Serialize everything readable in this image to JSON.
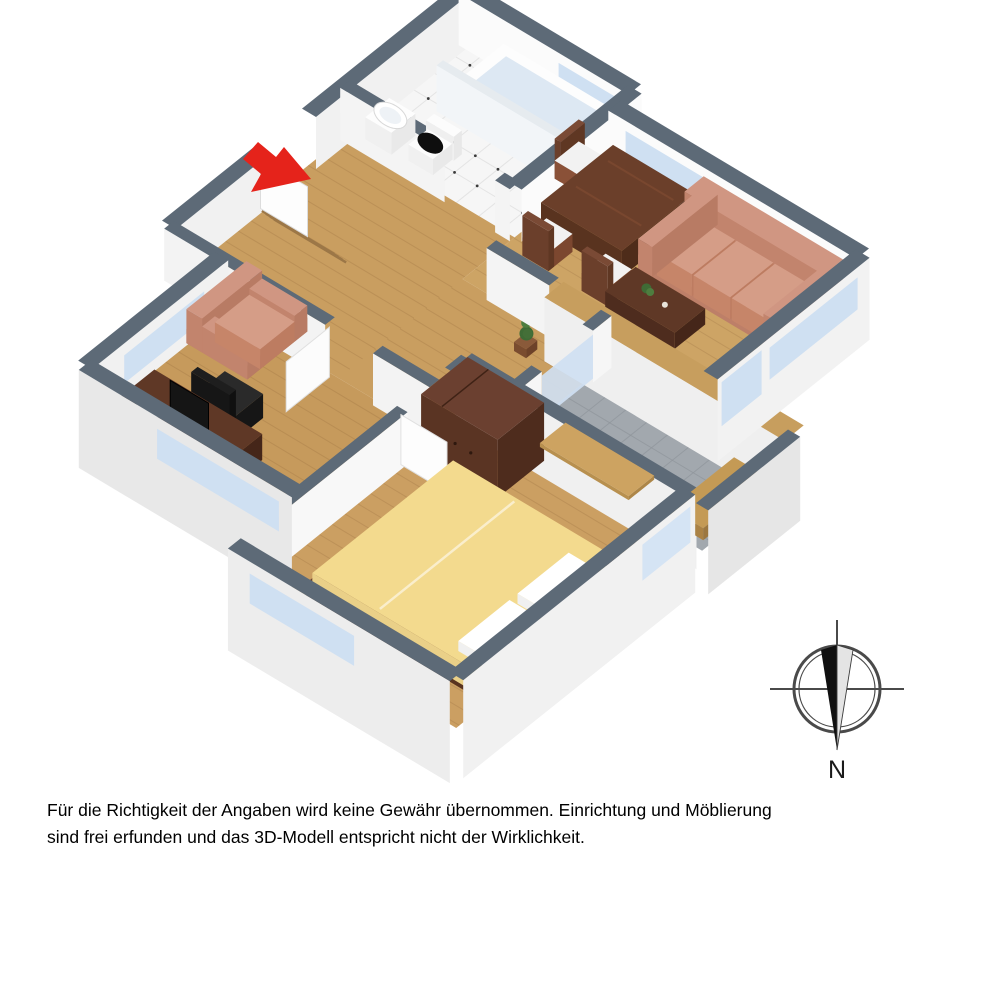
{
  "disclaimer": {
    "line1": "Für die Richtigkeit der Angaben wird keine Gewähr übernommen. Einrichtung und Möblierung",
    "line2": "sind frei erfunden und das 3D-Modell entspricht nicht der Wirklichkeit."
  },
  "compass": {
    "label": "N"
  },
  "colors": {
    "background": "#ffffff",
    "wall_cap": "#5d6a77",
    "wall_face": "#f4f4f4",
    "wall_face_bright": "#fbfbfb",
    "wall_outer": "#ebebeb",
    "floor_wood_living": "#cda465",
    "floor_wood_hall": "#c99e60",
    "floor_wood_study": "#c69a5c",
    "floor_wood_bedroom": "#cb9f62",
    "floor_tile_bath": "#f6f6f6",
    "floor_tile_balcony": "#a2a8ae",
    "window_glass": "#cfe0f2",
    "parapet_wood": "#c79e5e",
    "sofa": "#cf9480",
    "bed_spread": "#f3da8e",
    "furniture_wood_dark": "#5f3826",
    "dining_wood": "#6b3f2a",
    "mat_tan": "#cda361",
    "arrow_red": "#e5231b",
    "compass_ink": "#4a4a4a",
    "monitor_black": "#151515",
    "toilet_lid": "#0e0e0e"
  },
  "floorplan": {
    "elements": [
      "entrance-arrow",
      "entrance-door",
      "coat-rack",
      "bathtub",
      "bath-partition",
      "toilet",
      "sink",
      "dining-table",
      "dining-chairs",
      "sofa",
      "coffee-table",
      "houseplant",
      "armchair",
      "desk",
      "monitor",
      "office-chair",
      "wardrobe",
      "double-bed",
      "bedroom-door",
      "study-door",
      "balcony",
      "balcony-mat",
      "balcony-bench",
      "compass-rose"
    ]
  }
}
